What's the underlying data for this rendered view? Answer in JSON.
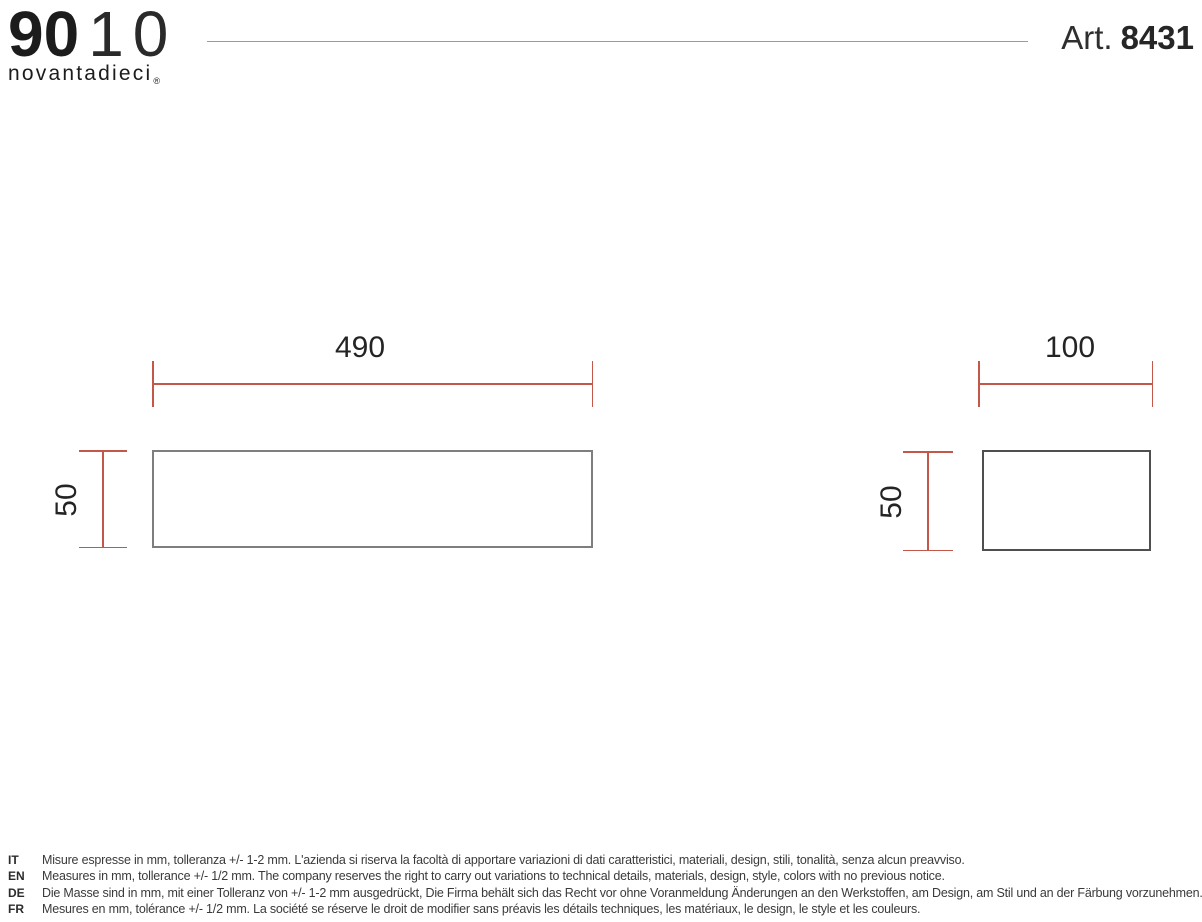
{
  "header": {
    "logo_bold": "90",
    "logo_thin_1": "1",
    "logo_thin_0": "0",
    "logo_subtitle": "novantadieci",
    "logo_registered": "®",
    "article_prefix": "Art.",
    "article_number": "8431"
  },
  "drawing": {
    "front_view": {
      "width_mm": "490",
      "height_mm": "50"
    },
    "side_view": {
      "width_mm": "100",
      "height_mm": "50"
    }
  },
  "notes": [
    {
      "lang": "IT",
      "text": "Misure espresse in mm, tolleranza +/- 1-2 mm. L'azienda si riserva la facoltà di apportare variazioni di dati caratteristici, materiali, design, stili, tonalità, senza alcun preavviso."
    },
    {
      "lang": "EN",
      "text": "Measures in mm, tollerance +/- 1/2 mm. The company reserves the right to carry out variations to technical details, materials, design, style, colors with no previous notice."
    },
    {
      "lang": "DE",
      "text": "Die Masse sind in mm, mit einer Tolleranz von +/- 1-2 mm ausgedrückt, Die Firma behält sich das Recht vor ohne Voranmeldung Änderungen an den Werkstoffen, am Design, am Stil und an der Färbung vorzunehmen."
    },
    {
      "lang": "FR",
      "text": "Mesures en mm, tolérance +/- 1/2 mm. La société se réserve le droit de modifier sans préavis les détails techniques, les matériaux, le design, le style et les couleurs."
    }
  ],
  "colors": {
    "dimension-red": "#c2574a",
    "rect-border-front": "#7e7e7e",
    "rect-border-side": "#4f4f4f",
    "text-dark": "#1c1c1c",
    "note-text": "#3a3a3a",
    "divider-gray": "#9b9b9b"
  }
}
